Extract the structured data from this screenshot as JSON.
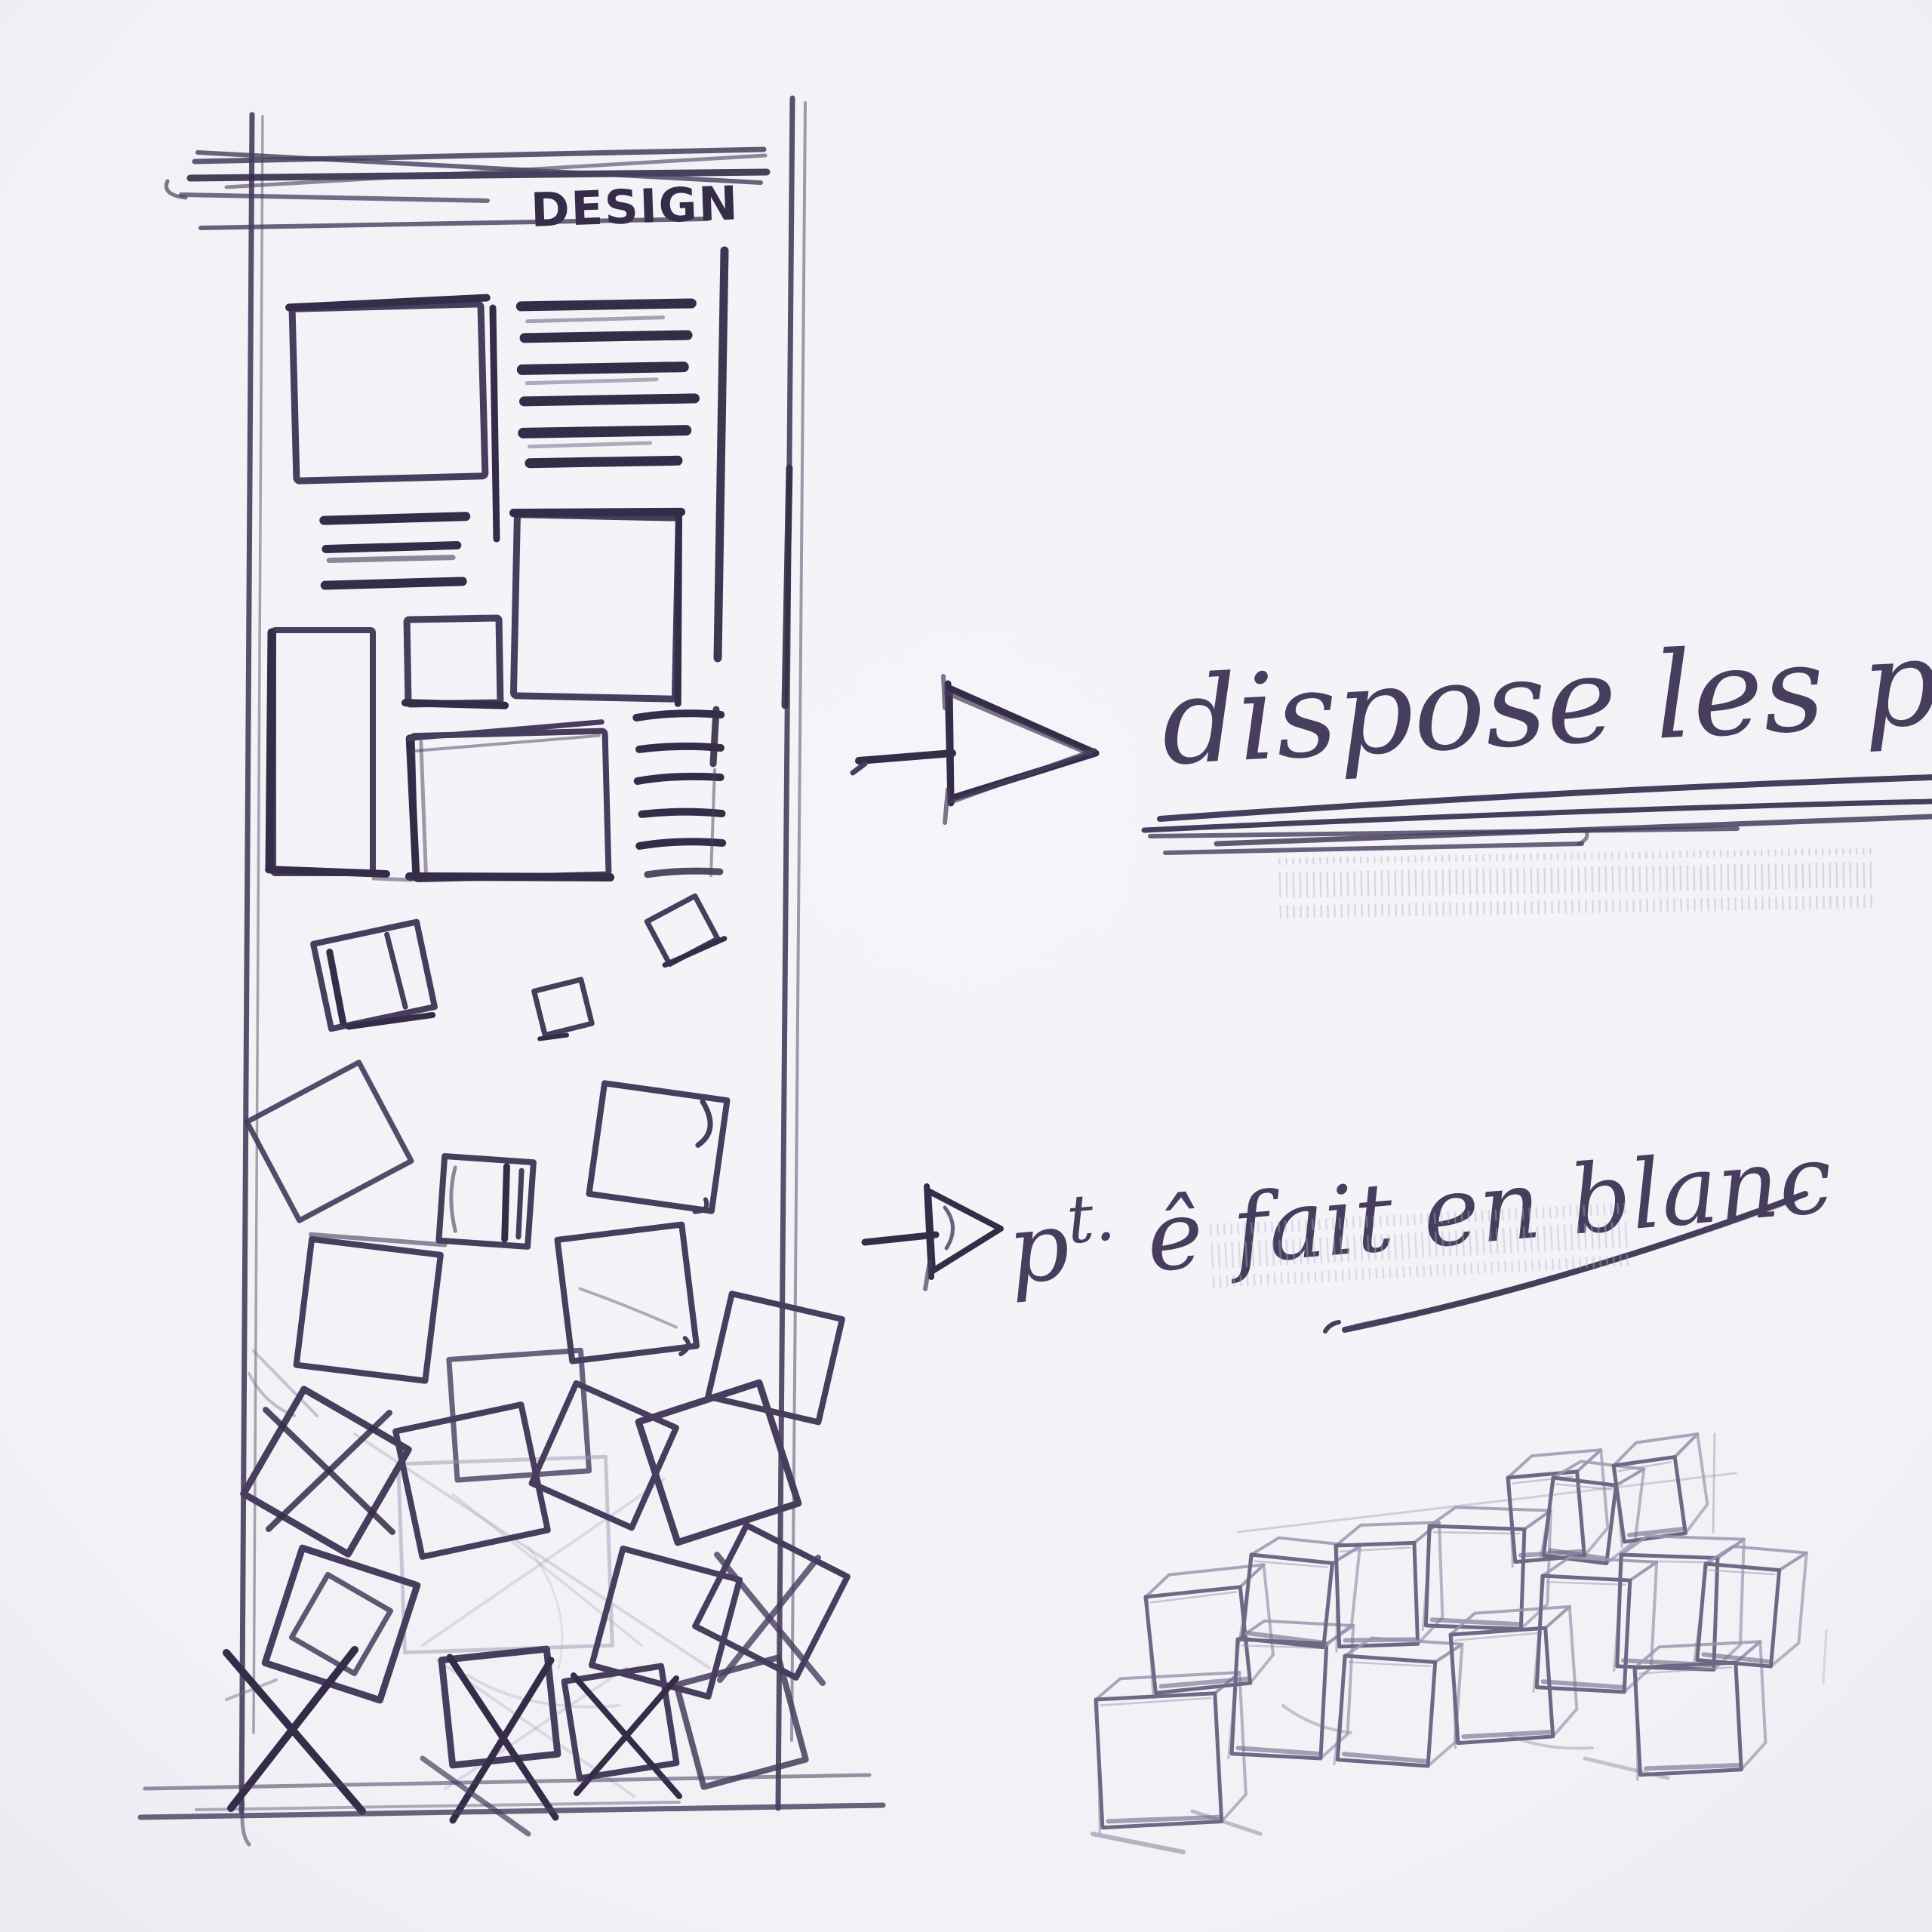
{
  "poster": {
    "title": "DESIGN"
  },
  "annotations": {
    "arrange_photos": {
      "text": "dispose les ph"
    },
    "maybe_white": {
      "p": "p",
      "t": "t.",
      "rest": " ê fait en blanc",
      "full": "pt. ê fait en blanc"
    }
  },
  "icons": {
    "arrow_1": "arrow-right-icon",
    "arrow_2": "arrow-right-icon"
  },
  "colors": {
    "paper": "#f1f1f6",
    "ink": "#473d5c",
    "ink_dark": "#352c48",
    "pencil": "#6f6885",
    "pencil_light": "#9c96b0"
  }
}
